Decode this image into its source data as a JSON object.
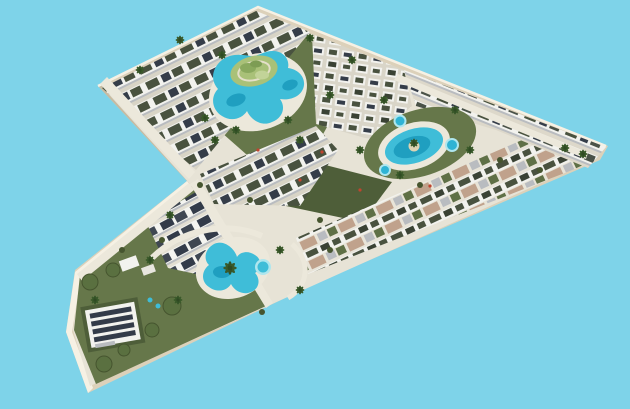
{
  "description": "Aerial 3D architectural rendering of a boomerang-shaped residential resort development with white apartment blocks, roof gardens, solar panels, lagoon-style pools and palm landscaping, floating on a plain sky-blue background",
  "render": {
    "background_color": "#7ed3e9",
    "colors": {
      "sand_base": "#dcd1ba",
      "sand_shadow": "#c7bba2",
      "sand_lit": "#f6f1e4",
      "road": "#e7e3d6",
      "street": "#ece8db",
      "building_white": "#f2f2ee",
      "building_shadow": "#b9bcc0",
      "roof_garden": "#49523f",
      "solar_panel": "#333b49",
      "lawn_green": "#66774a",
      "lawn_dark": "#4e5e39",
      "island_green": "#a9c178",
      "pool_turquoise": "#3fbdd8",
      "pool_deep": "#1f9fc0",
      "pool_light": "#aee6ee",
      "terrace_tan": "#c0a28c",
      "palm_green": "#2f4a23",
      "accent_red": "#c0442f"
    },
    "features": {
      "site_shape": "boomerang arrowhead pointing south-west",
      "pools": [
        "central-lagoon-pool-with-island-garden",
        "east-oval-pool-with-palm-island",
        "three-round-plunge-pools",
        "south-freeform-pool",
        "south-round-pool"
      ],
      "buildings": [
        "northwest-apartment-rows",
        "central-apartment-blocks",
        "east-top-apartment-rows",
        "southeast-townhouse-rows-with-tan-terraces",
        "south-solar-roof-block",
        "clubhouse-solar-roof-building"
      ],
      "landscape": [
        "island-maze-garden",
        "palm-trees",
        "tree-clusters",
        "lawns"
      ],
      "roads": [
        "perimeter-road",
        "internal-streets"
      ]
    }
  }
}
